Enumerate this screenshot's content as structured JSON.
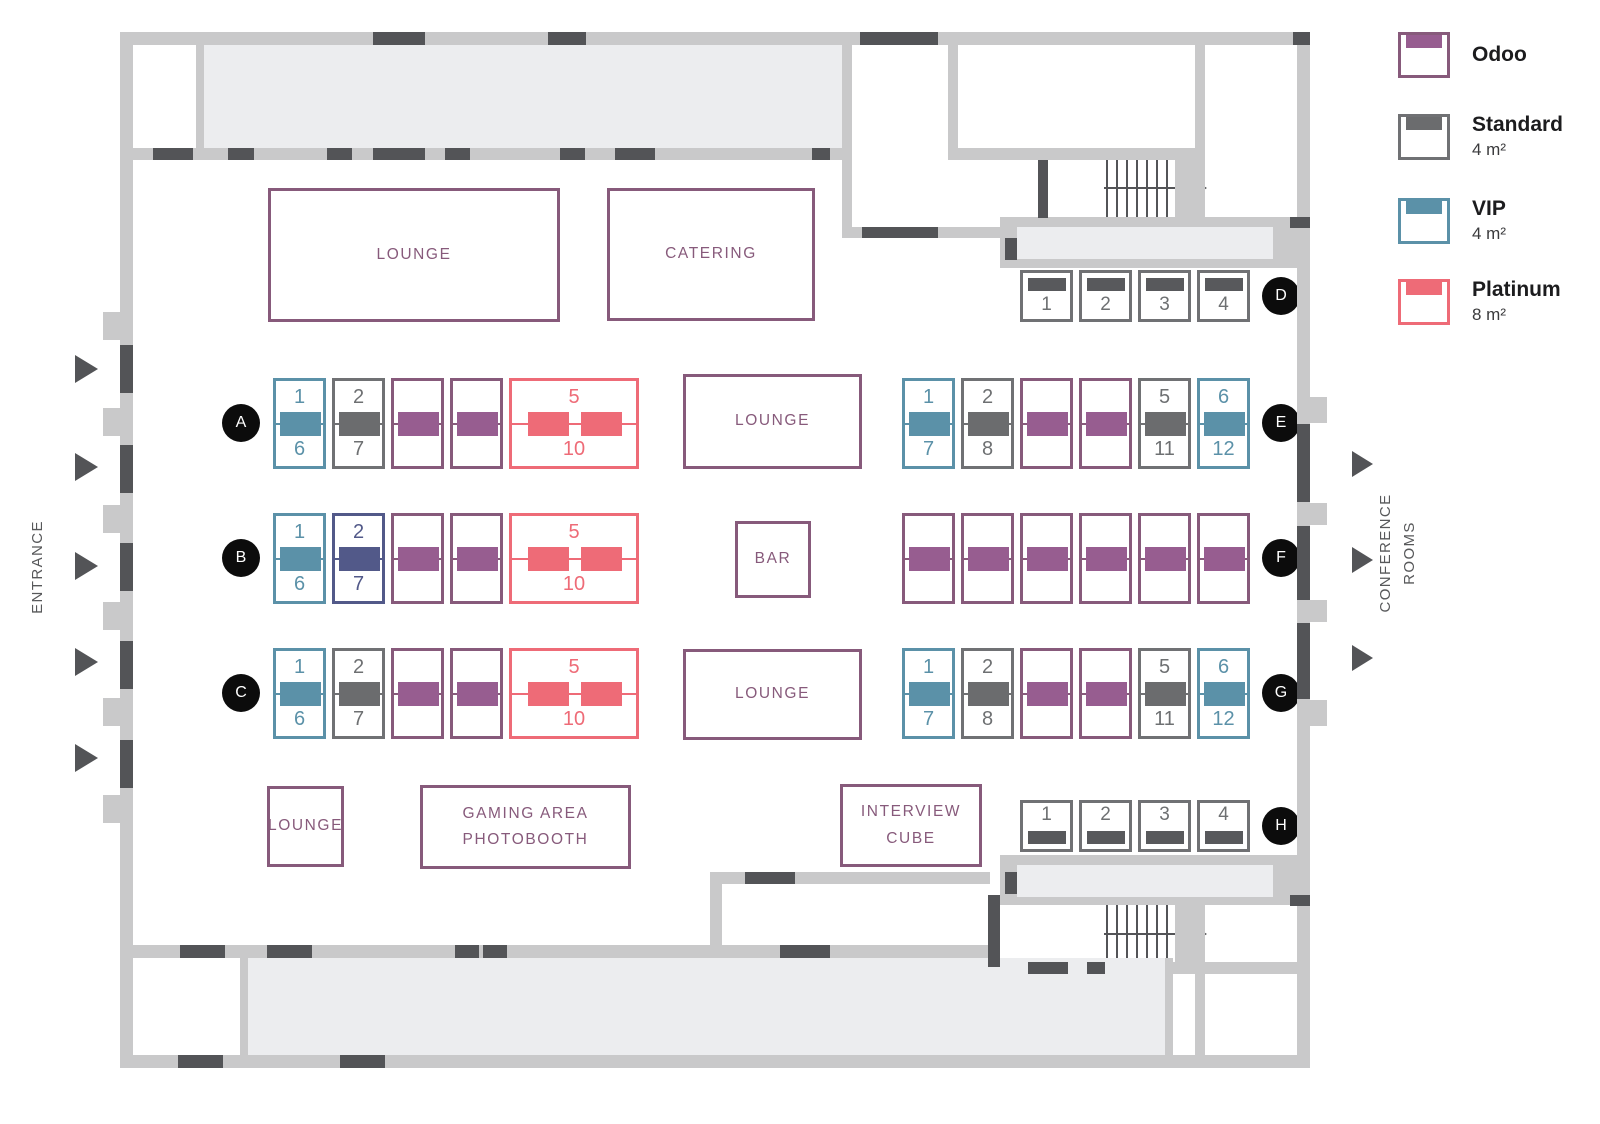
{
  "colors": {
    "wall": "#c9c9ca",
    "room": "#ecedef",
    "dark": "#535457",
    "accent_purple": "#875A7B",
    "badge_black": "#0c0c0c"
  },
  "booth_types": {
    "odoo": {
      "name": "Odoo",
      "border": "#875A7B",
      "fill": "#975D90",
      "num": "#875A7B"
    },
    "standard": {
      "name": "Standard",
      "border": "#707174",
      "fill": "#6b6c6e",
      "num": "#6e7072"
    },
    "vip": {
      "name": "VIP",
      "border": "#5B91A8",
      "fill": "#5B91A8",
      "num": "#5B91A8"
    },
    "platinum": {
      "name": "Platinum",
      "border": "#EE6B77",
      "fill": "#EE6B77",
      "num": "#EE6B77"
    },
    "indigo": {
      "name": "Indigo",
      "border": "#525989",
      "fill": "#525989",
      "num": "#525989"
    }
  },
  "legend": {
    "items": [
      {
        "type": "odoo",
        "name": "Odoo",
        "size": ""
      },
      {
        "type": "standard",
        "name": "Standard",
        "size": "4 m²"
      },
      {
        "type": "vip",
        "name": "VIP",
        "size": "4 m²"
      },
      {
        "type": "platinum",
        "name": "Platinum",
        "size": "8 m²"
      }
    ]
  },
  "side_labels": {
    "entrance": "ENTRANCE",
    "conference": [
      "CONFERENCE",
      "ROOMS"
    ]
  },
  "areas": {
    "lounge_top": "LOUNGE",
    "catering": "CATERING",
    "lounge_mid": "LOUNGE",
    "bar": "BAR",
    "lounge_low": "LOUNGE",
    "lounge_small": "LOUNGE",
    "gaming": [
      "GAMING AREA",
      "PHOTOBOOTH"
    ],
    "interview": [
      "INTERVIEW",
      "CUBE"
    ]
  },
  "rows": {
    "A": {
      "label": "A",
      "booths": [
        {
          "type": "vip",
          "top": "1",
          "bottom": "6"
        },
        {
          "type": "standard",
          "top": "2",
          "bottom": "7"
        },
        {
          "type": "odoo"
        },
        {
          "type": "odoo"
        },
        {
          "type": "platinum",
          "top": "5",
          "bottom": "10"
        }
      ]
    },
    "B": {
      "label": "B",
      "booths": [
        {
          "type": "vip",
          "top": "1",
          "bottom": "6"
        },
        {
          "type": "indigo",
          "top": "2",
          "bottom": "7"
        },
        {
          "type": "odoo"
        },
        {
          "type": "odoo"
        },
        {
          "type": "platinum",
          "top": "5",
          "bottom": "10"
        }
      ]
    },
    "C": {
      "label": "C",
      "booths": [
        {
          "type": "vip",
          "top": "1",
          "bottom": "6"
        },
        {
          "type": "standard",
          "top": "2",
          "bottom": "7"
        },
        {
          "type": "odoo"
        },
        {
          "type": "odoo"
        },
        {
          "type": "platinum",
          "top": "5",
          "bottom": "10"
        }
      ]
    },
    "D": {
      "label": "D",
      "booths": [
        {
          "type": "standard",
          "num": "1"
        },
        {
          "type": "standard",
          "num": "2"
        },
        {
          "type": "standard",
          "num": "3"
        },
        {
          "type": "standard",
          "num": "4"
        }
      ]
    },
    "E": {
      "label": "E",
      "booths": [
        {
          "type": "vip",
          "top": "1",
          "bottom": "7"
        },
        {
          "type": "standard",
          "top": "2",
          "bottom": "8"
        },
        {
          "type": "odoo"
        },
        {
          "type": "odoo"
        },
        {
          "type": "standard",
          "top": "5",
          "bottom": "11"
        },
        {
          "type": "vip",
          "top": "6",
          "bottom": "12"
        }
      ]
    },
    "F": {
      "label": "F",
      "booths": [
        {
          "type": "odoo"
        },
        {
          "type": "odoo"
        },
        {
          "type": "odoo"
        },
        {
          "type": "odoo"
        },
        {
          "type": "odoo"
        },
        {
          "type": "odoo"
        }
      ]
    },
    "G": {
      "label": "G",
      "booths": [
        {
          "type": "vip",
          "top": "1",
          "bottom": "7"
        },
        {
          "type": "standard",
          "top": "2",
          "bottom": "8"
        },
        {
          "type": "odoo"
        },
        {
          "type": "odoo"
        },
        {
          "type": "standard",
          "top": "5",
          "bottom": "11"
        },
        {
          "type": "vip",
          "top": "6",
          "bottom": "12"
        }
      ]
    },
    "H": {
      "label": "H",
      "booths": [
        {
          "type": "standard",
          "num": "1"
        },
        {
          "type": "standard",
          "num": "2"
        },
        {
          "type": "standard",
          "num": "3"
        },
        {
          "type": "standard",
          "num": "4"
        }
      ]
    }
  }
}
